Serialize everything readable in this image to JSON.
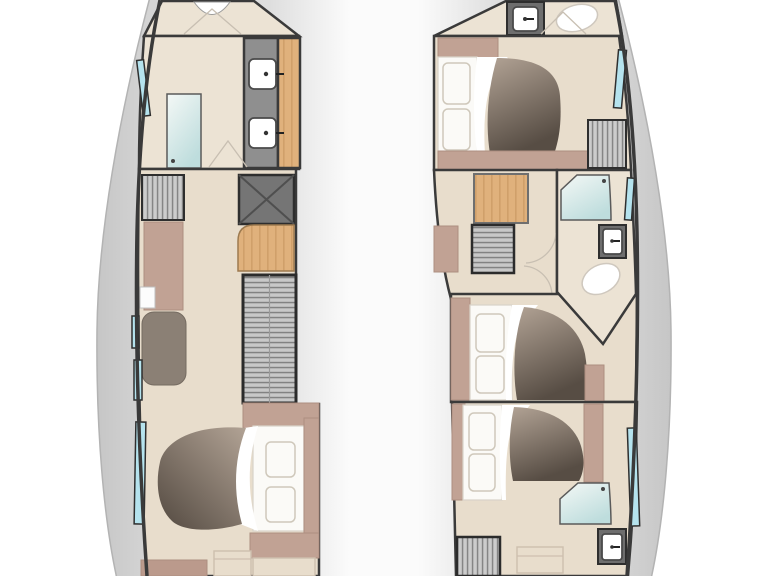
{
  "diagram": {
    "type": "catamaran-lower-deck-floor-plan",
    "orientation": "bow-at-top",
    "port_hull": {
      "rooms": [
        {
          "name": "bow-locker",
          "fixtures": [
            "deck-hatch",
            "entry-door"
          ]
        },
        {
          "name": "forward-bathroom",
          "fixtures": [
            "shower",
            "double-sink-vanity",
            "hull-window"
          ]
        },
        {
          "name": "galley-corridor",
          "fixtures": [
            "vented-cabinet",
            "counter",
            "galley-sink",
            "seat",
            "engine-hatch",
            "wood-steps",
            "companionway-stairs",
            "hull-windows"
          ]
        },
        {
          "name": "aft-cabin",
          "fixtures": [
            "double-bed",
            "pillows",
            "duvet",
            "bench",
            "hull-window"
          ]
        }
      ]
    },
    "starboard_hull": {
      "rooms": [
        {
          "name": "bow-bathroom",
          "fixtures": [
            "sink",
            "toilet",
            "entry-door"
          ]
        },
        {
          "name": "forward-cabin",
          "fixtures": [
            "double-bed",
            "pillows",
            "duvet",
            "vented-cabinet",
            "hull-window"
          ]
        },
        {
          "name": "stair-lobby",
          "fixtures": [
            "wood-stairs",
            "vented-cabinet",
            "cabinet"
          ]
        },
        {
          "name": "mid-bathroom",
          "fixtures": [
            "shower",
            "sink",
            "toilet"
          ]
        },
        {
          "name": "mid-cabin",
          "fixtures": [
            "double-bed",
            "pillows",
            "duvet"
          ]
        },
        {
          "name": "aft-cabin",
          "fixtures": [
            "double-bed",
            "pillows",
            "duvet",
            "shower",
            "sink",
            "vented-cabinet",
            "bench",
            "hull-window"
          ]
        }
      ]
    }
  },
  "colors": {
    "wall": "#3a3a3a",
    "floor": "#e8ddcc",
    "floor_light": "#ece3d4",
    "mauve": "#c1a294",
    "mauve_dark": "#bb9a8c",
    "mauve_stroke": "#ad8f81",
    "counter_gray": "#8f8f8f",
    "fixture_gray": "#6e6e6e",
    "window": "#b5e3ee",
    "white": "#ffffff",
    "seat": "#8b8075",
    "pillow_line": "#cfc8bb",
    "door_mark": "#c8bfb2",
    "deck_edge": "#c6c6c6",
    "deck_mid": "#dedede",
    "shower_light": "#f4f8f6",
    "shower_dark": "#bedddd",
    "duvet_light": "#b2a395",
    "duvet_dark": "#574d44",
    "wood": "#e0b17c",
    "wood_grain": "#cc9c66",
    "hatch_bg": "#cccccc",
    "hatch_line": "#858585"
  }
}
